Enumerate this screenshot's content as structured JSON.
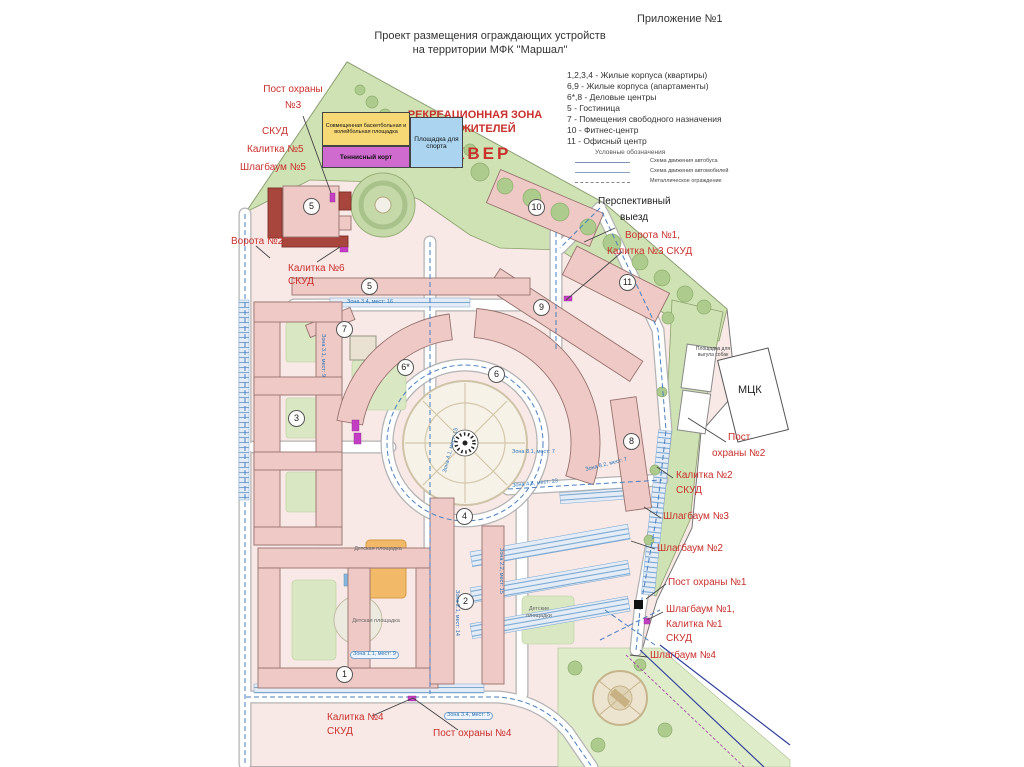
{
  "header": {
    "annex": "Приложение №1",
    "title1": "Проект размещения ограждающих устройств",
    "title2": "на территории МФК \"Маршал\""
  },
  "key": {
    "items": [
      "1,2,3,4 - Жилые корпуса (квартиры)",
      "6,9 - Жилые корпуса (апартаменты)",
      "6*,8 - Деловые центры",
      "5 - Гостиница",
      "7 - Помещения свободного назначения",
      "10 - Фитнес-центр",
      "11 - Офисный центр"
    ],
    "symbols_title": "Условные обозначения",
    "symbols": [
      "Схема движения автобуса",
      "Схема движения автомобилей",
      "Металлическое ограждение"
    ]
  },
  "recreation": {
    "line1": "РЕКРЕАЦИОННАЯ ЗОНА",
    "line2": "ДЛЯ ЖИТЕЛЕЙ",
    "square": "СКВЕР"
  },
  "sports": {
    "combined": "Совмещенная баскетбольная и волейбольная площадка",
    "tennis": "Теннисный корт",
    "sport_ground": "Площадка для спорта"
  },
  "security": {
    "post3a": "Пост охраны",
    "post3b": "№3",
    "skud": "СКУД",
    "gate5": "Калитка №5",
    "barrier5": "Шлагбаум №5",
    "vorota2": "Ворота №2",
    "gate6": "Калитка №6",
    "persp1": "Перспективный",
    "persp2": "выезд",
    "vorota1": "Ворота №1,",
    "gate3": "Калитка №3  СКУД",
    "post2a": "Пост",
    "post2b": "охраны №2",
    "gate2": "Калитка №2",
    "barrier3": "Шлагбаум №3",
    "barrier2": "Шлагбаум №2",
    "post1": "Пост охраны №1",
    "barrier1": "Шлагбаум №1,",
    "gate1": "Калитка №1",
    "barrier4": "Шлагбаум №4",
    "gate4": "Калитка №4",
    "post4": "Пост охраны №4"
  },
  "places": {
    "mck": "МЦК",
    "dog_area": "Площадка для выгула собак",
    "playground": "Детская площадка",
    "playgrounds": "Детские площадки"
  },
  "buildings": {
    "b1": "1",
    "b2": "2",
    "b3": "3",
    "b4": "4",
    "b5": "5",
    "b6": "6",
    "b6s": "6*",
    "b7": "7",
    "b8": "8",
    "b9": "9",
    "b10": "10",
    "b11": "11"
  },
  "zones": [
    "Зона 3.4, мест: 16",
    "Зона 3.1, мест: 9",
    "Зона 4.1, мест: 15",
    "Зона 8.1, мест: 7",
    "Зона 8.2, мест: 7",
    "Зона 4.5, мест: 23",
    "Зона 2.2, мест: 15",
    "Зона 2.1, мест: 14",
    "Зона 1.1, мест: 9",
    "Зона 3.4, мест: 5"
  ],
  "colors": {
    "label_red": "#c9302c",
    "zone_blue": "#2e74b5",
    "park_green": "#cfe2b4",
    "building_pink": "#eec9c5",
    "accent_dark_red": "#a8453c"
  }
}
